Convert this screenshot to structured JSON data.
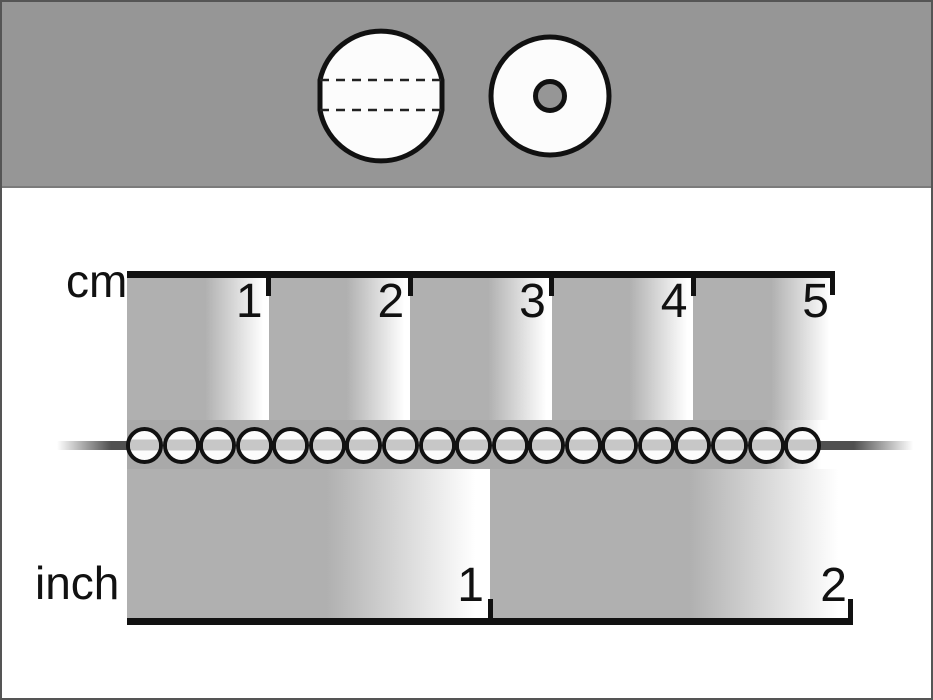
{
  "image": {
    "type": "bead-size-measurement-diagram",
    "background": "#ffffff",
    "border_color": "#555555"
  },
  "header": {
    "background": "#969696",
    "diagrams": [
      {
        "name": "bead-side-view"
      },
      {
        "name": "bead-front-view"
      }
    ]
  },
  "ruler": {
    "cm": {
      "label": "cm",
      "ticks": [
        "1",
        "2",
        "3",
        "4",
        "5"
      ]
    },
    "inch": {
      "label": "inch",
      "ticks": [
        "1",
        "2"
      ]
    },
    "beads": {
      "count": 19
    },
    "colors": {
      "band": "#b0b0b0",
      "band_fade": "#ffffff",
      "mid_strip": "#a9a9a9",
      "stripe": "#c7c7c7",
      "string": "#505050",
      "ink": "#111111",
      "bead_fill": "#fcfcfc",
      "hole_fill": "#969696"
    }
  }
}
